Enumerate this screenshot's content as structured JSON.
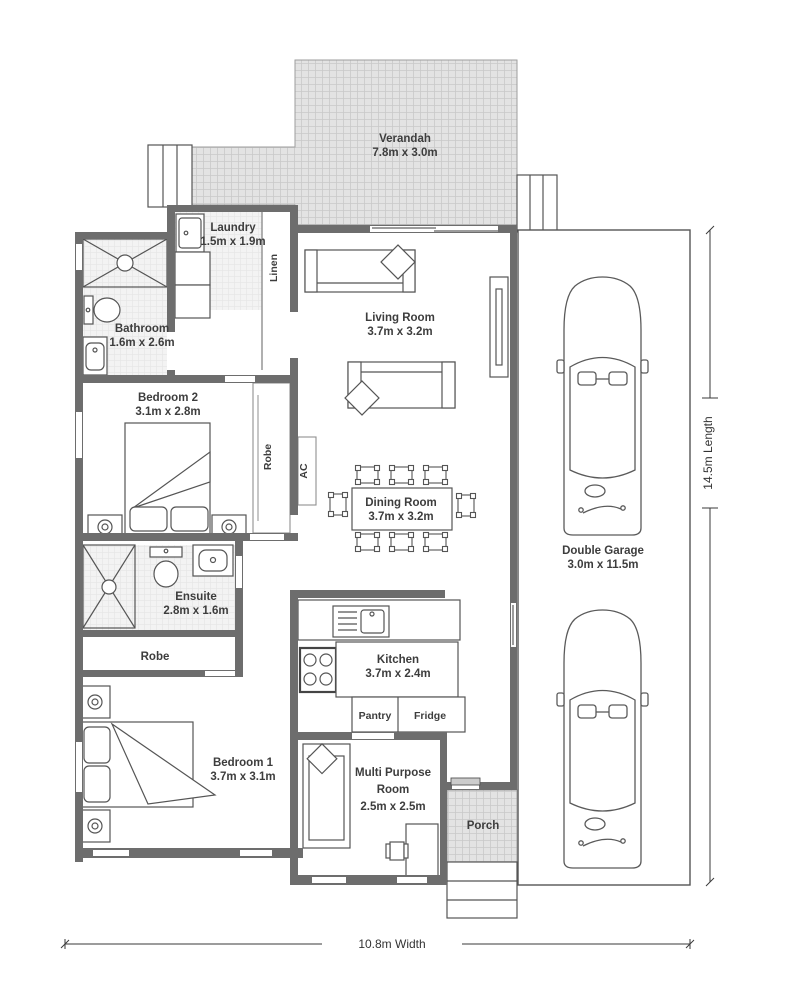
{
  "rooms": [
    {
      "name": "Verandah",
      "dims": "7.8m x 3.0m"
    },
    {
      "name": "Laundry",
      "dims": "1.5m x 1.9m"
    },
    {
      "name": "Bathroom",
      "dims": "1.6m x 2.6m"
    },
    {
      "name": "Living Room",
      "dims": "3.7m x 3.2m"
    },
    {
      "name": "Bedroom 2",
      "dims": "3.1m x 2.8m"
    },
    {
      "name": "Dining Room",
      "dims": "3.7m x 3.2m"
    },
    {
      "name": "Double Garage",
      "dims": "3.0m x 11.5m"
    },
    {
      "name": "Ensuite",
      "dims": "2.8m x 1.6m"
    },
    {
      "name": "Kitchen",
      "dims": "3.7m x 2.4m"
    },
    {
      "name": "Bedroom 1",
      "dims": "3.7m x 3.1m"
    },
    {
      "name": "Multi Purpose",
      "name_line2": "Room",
      "dims": "2.5m x 2.5m"
    },
    {
      "name": "Porch"
    }
  ],
  "fixtures": {
    "linen": "Linen",
    "robe_bedroom2": "Robe",
    "robe_bedroom1": "Robe",
    "ac": "AC",
    "pantry": "Pantry",
    "fridge": "Fridge"
  },
  "dimensions": {
    "width": "10.8m Width",
    "length": "14.5m Length"
  },
  "colors": {
    "wall": "#6d6d6d",
    "hatch_bg": "#e3e3e3",
    "hatch_line": "#c9c9c9",
    "tile_bg": "#f3f3f3",
    "tile_line": "#e5e5e5",
    "outline": "#555555",
    "text": "#3d3d3d"
  }
}
